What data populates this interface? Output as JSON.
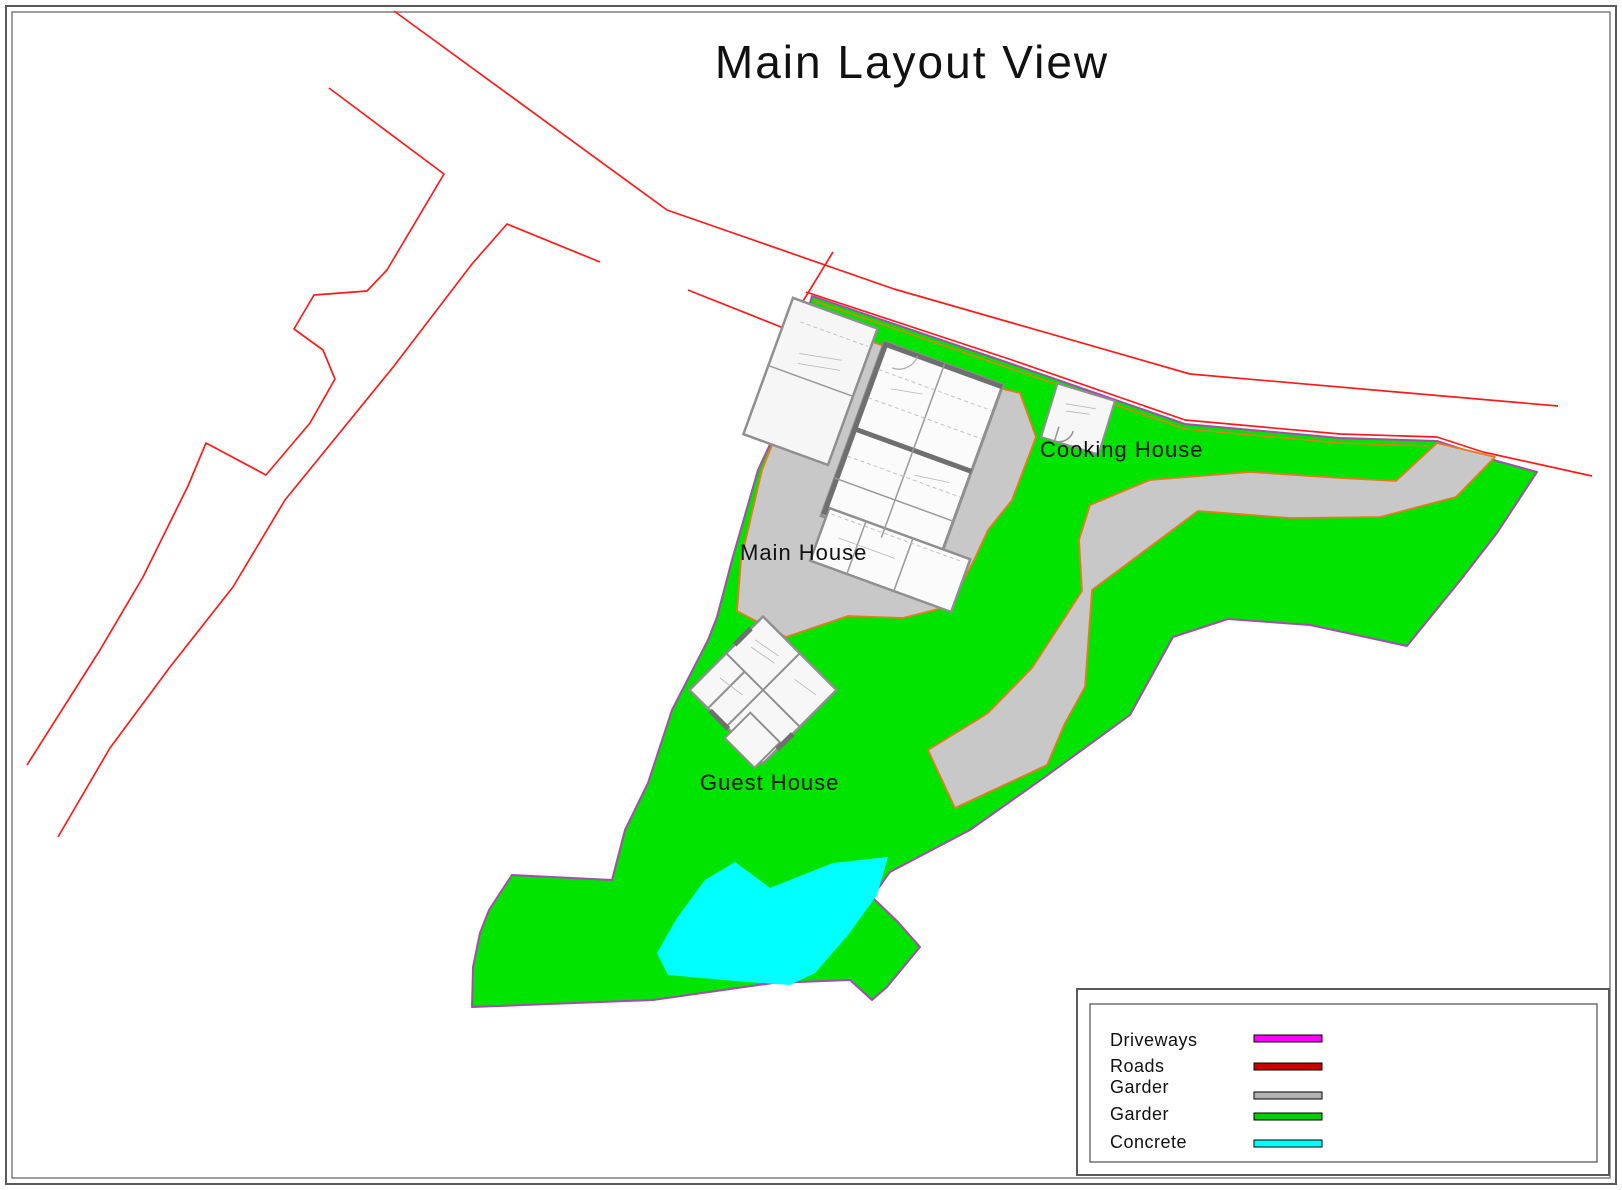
{
  "page": {
    "title": "Main Layout View"
  },
  "map": {
    "labels": {
      "main_house": "Main House",
      "guest_house": "Guest  House",
      "cooking_house": "Cooking House"
    }
  },
  "legend": {
    "items": [
      {
        "label": "Driveways",
        "color": "#FF00FF"
      },
      {
        "label": "Roads",
        "color": "#CC0000"
      },
      {
        "label": "Garder",
        "color": "#B3B3B3"
      },
      {
        "label": "Garder",
        "color": "#00CF00"
      },
      {
        "label": "Concrete",
        "color": "#00FFFF"
      }
    ]
  },
  "colors": {
    "garden_green": "#00E400",
    "driveway_gray": "#C8C8C8",
    "pond_cyan": "#00FFFF",
    "road_red": "#FF1A1A",
    "boundary_purple": "#A84BB0",
    "edge_orange": "#E87A1E",
    "wall_gray": "#8F8F8F"
  }
}
